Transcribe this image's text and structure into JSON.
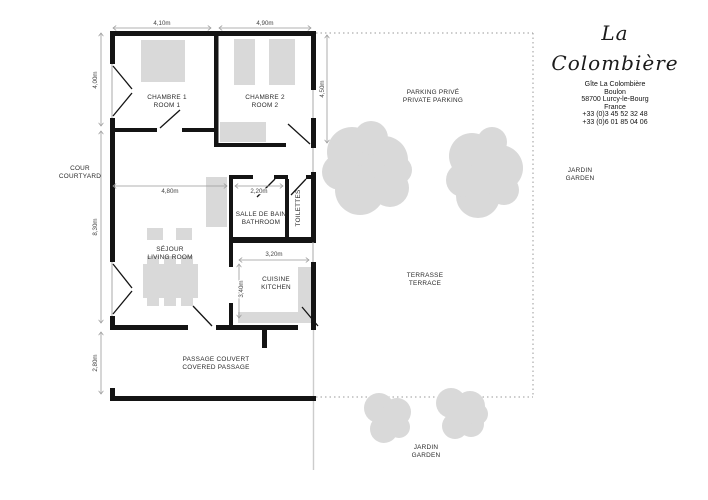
{
  "palette": {
    "wall": "#141414",
    "furniture": "#d9d9d9",
    "boundary_dots": "#9a9a9a",
    "dimension_lines": "#999999",
    "label_text": "#2b2b2b"
  },
  "logo": {
    "script_name": "La Colombière"
  },
  "contact": {
    "name": "Gîte La Colombière",
    "address_line1": "Boulon",
    "address_line2": "58700 Lurcy-le-Bourg",
    "address_line3": "France",
    "phone1": "+33 (0)3 45 52 32 48",
    "phone2": "+33 (0)6 01 85 04 06"
  },
  "rooms": {
    "chambre1": {
      "fr": "CHAMBRE 1",
      "en": "ROOM 1"
    },
    "chambre2": {
      "fr": "CHAMBRE 2",
      "en": "ROOM 2"
    },
    "bathroom": {
      "fr": "SALLE DE BAIN",
      "en": "BATHROOM"
    },
    "toilets": {
      "fr": "TOILETTES"
    },
    "living": {
      "fr": "SÉJOUR",
      "en": "LIVING ROOM"
    },
    "kitchen": {
      "fr": "CUISINE",
      "en": "KITCHEN"
    }
  },
  "outdoor": {
    "courtyard": {
      "fr": "COUR",
      "en": "COURTYARD"
    },
    "parking": {
      "fr": "PARKING PRIVÉ",
      "en": "PRIVATE PARKING"
    },
    "terrace": {
      "fr": "TERRASSE",
      "en": "TERRACE"
    },
    "garden_right": {
      "fr": "JARDIN",
      "en": "GARDEN"
    },
    "garden_bottom": {
      "fr": "JARDIN",
      "en": "GARDEN"
    },
    "passage": {
      "fr": "PASSAGE COUVERT",
      "en": "COVERED PASSAGE"
    }
  },
  "dimensions": {
    "room1_width": "4,10m",
    "room2_width": "4,90m",
    "room1_depth": "4,00m",
    "room2_depth": "4,50m",
    "living_width": "4,80m",
    "living_depth": "8,30m",
    "bathroom_width": "2,20m",
    "kitchen_width": "3,20m",
    "kitchen_depth": "3,40m",
    "passage_depth": "2,80m"
  }
}
